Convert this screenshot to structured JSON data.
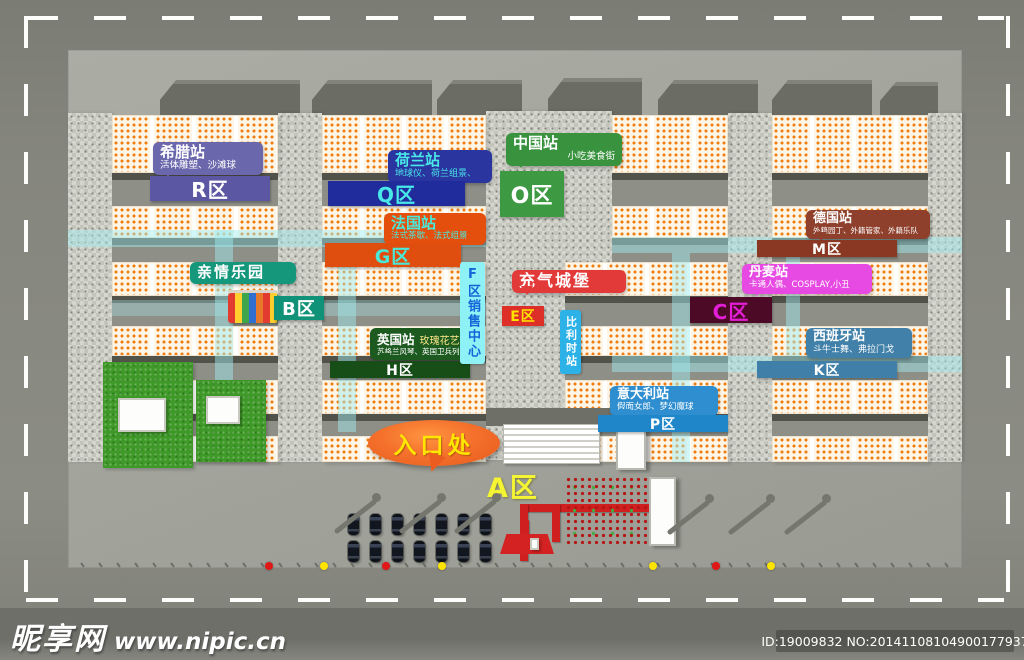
{
  "stations": {
    "greece": {
      "title": "希腊站",
      "subtitle": "活体雕塑、沙滩球",
      "zone": "R区",
      "color": "#6b67ac",
      "zone_color": "#5b57a2",
      "text_color": "#ffffff"
    },
    "netherlands": {
      "title": "荷兰站",
      "subtitle": "地球仪、荷兰组景、",
      "zone": "Q区",
      "color": "#2a35a0",
      "zone_color": "#202c9c",
      "text_color": "#49e8e8"
    },
    "china": {
      "title": "中国站",
      "subtitle": "小吃美食街",
      "zone": "O区",
      "color": "#38923e",
      "zone_color": "#3d9a43",
      "text_color": "#ffffff"
    },
    "france": {
      "title": "法国站",
      "subtitle": "法式茶歇、法式组景",
      "zone": "G区",
      "color": "#e44f0e",
      "zone_color": "#df4e0e",
      "text_color": "#49e8d8"
    },
    "germany": {
      "title": "德国站",
      "subtitle": "外籍园丁、外籍管家、外籍乐队",
      "zone": "M区",
      "color": "#8e402c",
      "zone_color": "#8a3824",
      "text_color": "#ffffff"
    },
    "denmark": {
      "title": "丹麦站",
      "subtitle": "卡通人偶、COSPLAY,小丑",
      "zone": "C区",
      "color": "#e74ae2",
      "zone_color": "#4d0a26",
      "zone_text_color": "#e31ed6"
    },
    "uk": {
      "title": "英国站",
      "tagline": "玫瑰花艺",
      "subtitle": "苏格兰风琴、英国卫兵列队",
      "zone": "H区",
      "color": "#1d5a1f",
      "zone_color": "#174e18",
      "text_color": "#ffffff"
    },
    "spain": {
      "title": "西班牙站",
      "subtitle": "斗牛士舞、弗拉门戈",
      "zone": "K区",
      "color": "#4180a8",
      "zone_color": "#3f7fa8",
      "text_color": "#ffffff"
    },
    "italy": {
      "title": "意大利站",
      "subtitle": "假面女郎、梦幻魔球",
      "zone": "P区",
      "color": "#2e8ecf",
      "zone_color": "#1f87c9",
      "text_color": "#ffffff"
    },
    "belgium": {
      "title": "比利时站",
      "color": "#2cb2e6",
      "text_color": "#ffffff"
    }
  },
  "features": {
    "family_park": {
      "label": "亲情乐园",
      "zone": "B区",
      "color": "#15977c",
      "zone_color": "#0f9277"
    },
    "sales_center": {
      "label": "F区销售中心",
      "color": "#8df1f5",
      "text_color": "#1565d8"
    },
    "inflatable_castle": {
      "label": "充气城堡",
      "zone": "E区",
      "color": "#e23939",
      "zone_color": "#dd2f28",
      "zone_text_color": "#ffe400"
    },
    "entrance": {
      "label": "入口处",
      "zone": "A区",
      "color": "#f2612a",
      "text_color": "#ffe600",
      "zone_text_color": "#f5f533"
    }
  },
  "watermark": {
    "site_name": "昵享网",
    "site_url": "www.nipic.cn",
    "id_text": "ID:19009832 NO:20141108104900177937"
  }
}
